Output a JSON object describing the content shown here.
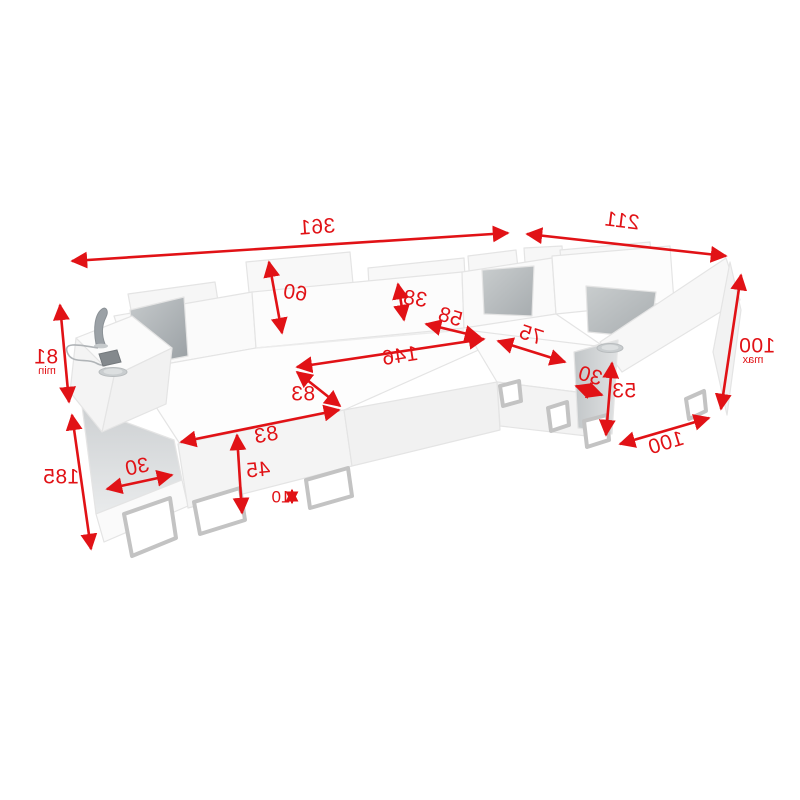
{
  "diagram": {
    "title": "corner-sofa-dimension-diagram",
    "accent_color": "#e11216",
    "pillow_color": "#aeb3b6",
    "text_style": "mirrored",
    "dims": {
      "total_width": "361",
      "side_depth": "211",
      "back_height": "100",
      "back_height_qualifier": "max",
      "arm_front_width": "100",
      "arm_height_right": "53",
      "arm_width_right": "30",
      "seat_depth_right": "75",
      "bed_length": "146",
      "corner_width": "58",
      "headrest_height": "38",
      "backrest_height": "60",
      "chaise_side_depth": "83",
      "chaise_front_width": "83",
      "seat_height": "45",
      "floor_clearance": "10",
      "arm_width_left": "30",
      "chaise_length": "185",
      "arm_height_left": "81",
      "arm_height_left_qualifier": "min"
    }
  }
}
